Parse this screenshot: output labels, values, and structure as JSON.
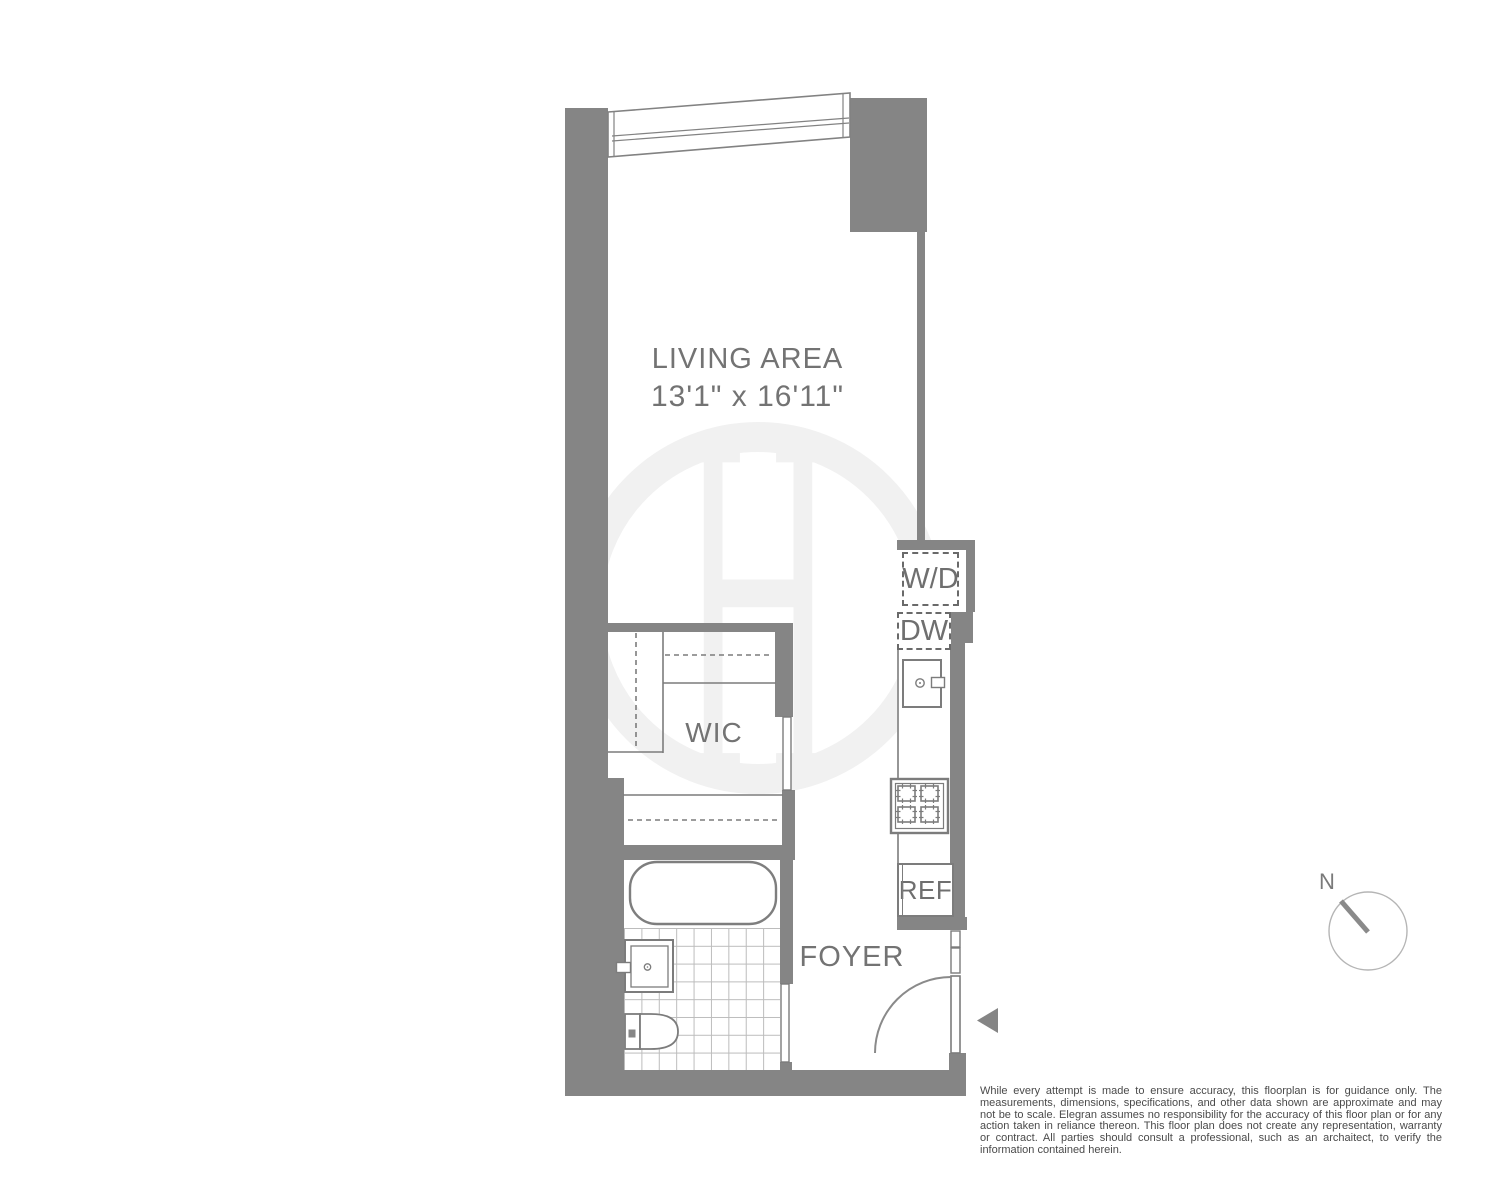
{
  "floorplan": {
    "living_area": {
      "label": "LIVING AREA",
      "dimensions": "13'1\" x 16'11\""
    },
    "wic": {
      "label": "WIC"
    },
    "foyer": {
      "label": "FOYER"
    },
    "kitchen": {
      "washer_dryer": "W/D",
      "dishwasher": "DW",
      "refrigerator": "REF"
    }
  },
  "compass": {
    "north": "N"
  },
  "watermark": {
    "monogram": "H"
  },
  "disclaimer": {
    "text": "While every attempt is made to ensure accuracy, this floorplan is for guidance only. The measurements, dimensions, specifications, and other data shown are approximate and may not be to scale. Elegran assumes no responsibility for the accuracy of this floor plan or for any action taken in reliance thereon. This floor plan does not create any representation, warranty or contract. All parties should consult a professional, such as an archaitect, to verify the information contained herein."
  },
  "colors": {
    "wall": "#858585",
    "fixture_line": "#7c7c7c",
    "label_text": "#737373",
    "tile_line": "#bcbcbc",
    "watermark": "#f1f1f1",
    "disclaimer_text": "#4a4a4a"
  }
}
